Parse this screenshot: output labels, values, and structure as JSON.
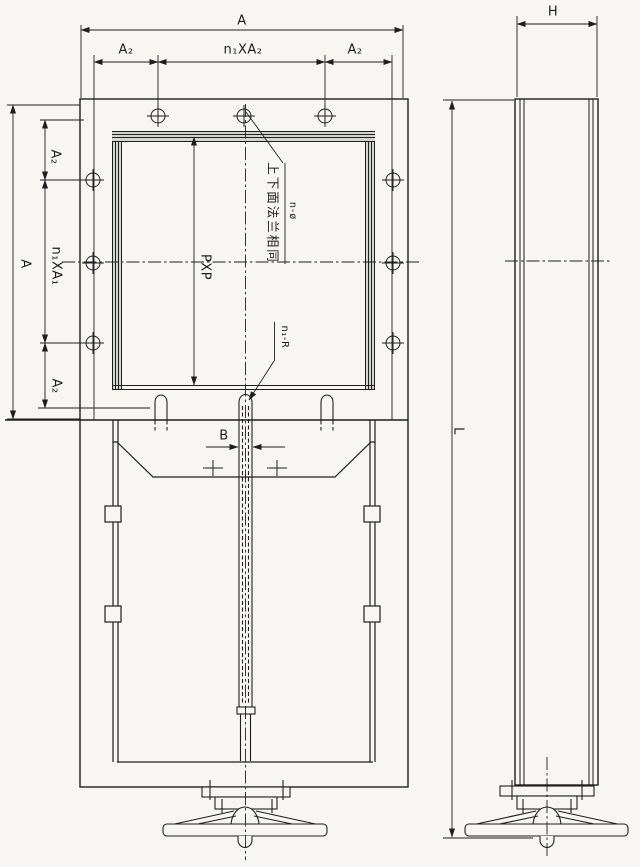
{
  "drawing_type": "valve engineering drawing, front and side views",
  "front_view": {
    "width_dims": {
      "overall": "A",
      "edge_left": "A₂",
      "pitch": "n₁XA₂",
      "edge_right": "A₂"
    },
    "height_dims": {
      "overall": "A",
      "edge_top": "A₂",
      "pitch": "n₁XA₁",
      "edge_bottom": "A₂"
    },
    "opening_dim": "PXP",
    "slot_width_dim": "B",
    "flange_note": "上下面法兰相同",
    "bolt_holes_label": "n-ø",
    "slot_label": "n₁-R"
  },
  "side_view": {
    "depth_dim": "H",
    "length_dim": "L"
  },
  "colors": {
    "ink": "#1f1f1f",
    "paper": "#f7f6f2",
    "seal_band": "#5a5a5a"
  }
}
